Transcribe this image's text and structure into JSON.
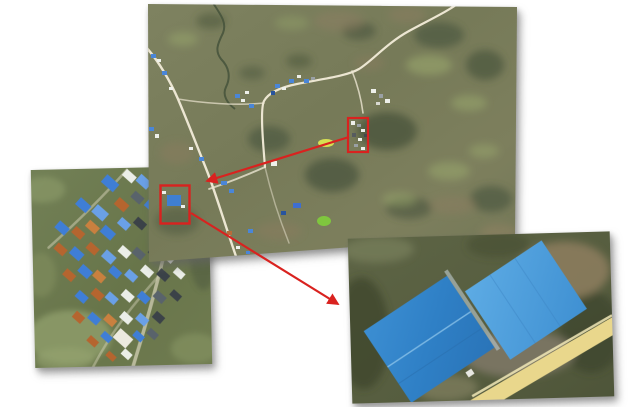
{
  "figure": {
    "type": "aerial-imagery-collage",
    "background_color": "#ffffff",
    "annotation_color": "#d9221f",
    "panels": [
      {
        "id": "main-map",
        "role": "overview",
        "label": "aerial overview of rural area with winding roads and scattered villages"
      },
      {
        "id": "village-inset",
        "role": "zoom-detail",
        "label": "village close-up with blue, orange, white and grey rooftops"
      },
      {
        "id": "warehouse-inset",
        "role": "zoom-detail",
        "label": "close-up of two large blue-roofed buildings beside a sand-colored road"
      }
    ],
    "markers": [
      {
        "id": "highlight-box-a",
        "panel": "main-map",
        "target": "building-cluster"
      },
      {
        "id": "highlight-box-b",
        "panel": "main-map",
        "target": "blue-roof-building"
      }
    ],
    "arrows": [
      {
        "id": "arrow-a",
        "from": "highlight-box-a",
        "to": "village-inset-corner"
      },
      {
        "id": "arrow-b",
        "from": "highlight-box-b",
        "to": "warehouse-inset-edge"
      }
    ],
    "palette": {
      "terrain_olive": "#7d8160",
      "forest_dark": "#46513a",
      "field_light": "#9cab6e",
      "soil_brown": "#8b7d60",
      "road_white": "#ece6d2",
      "roof_blue": "#3f8fd6",
      "roof_orange": "#b5652f",
      "roof_white": "#ebeee8",
      "roof_slate": "#59636b",
      "sand_road_yellow": "#e9d78c"
    }
  }
}
